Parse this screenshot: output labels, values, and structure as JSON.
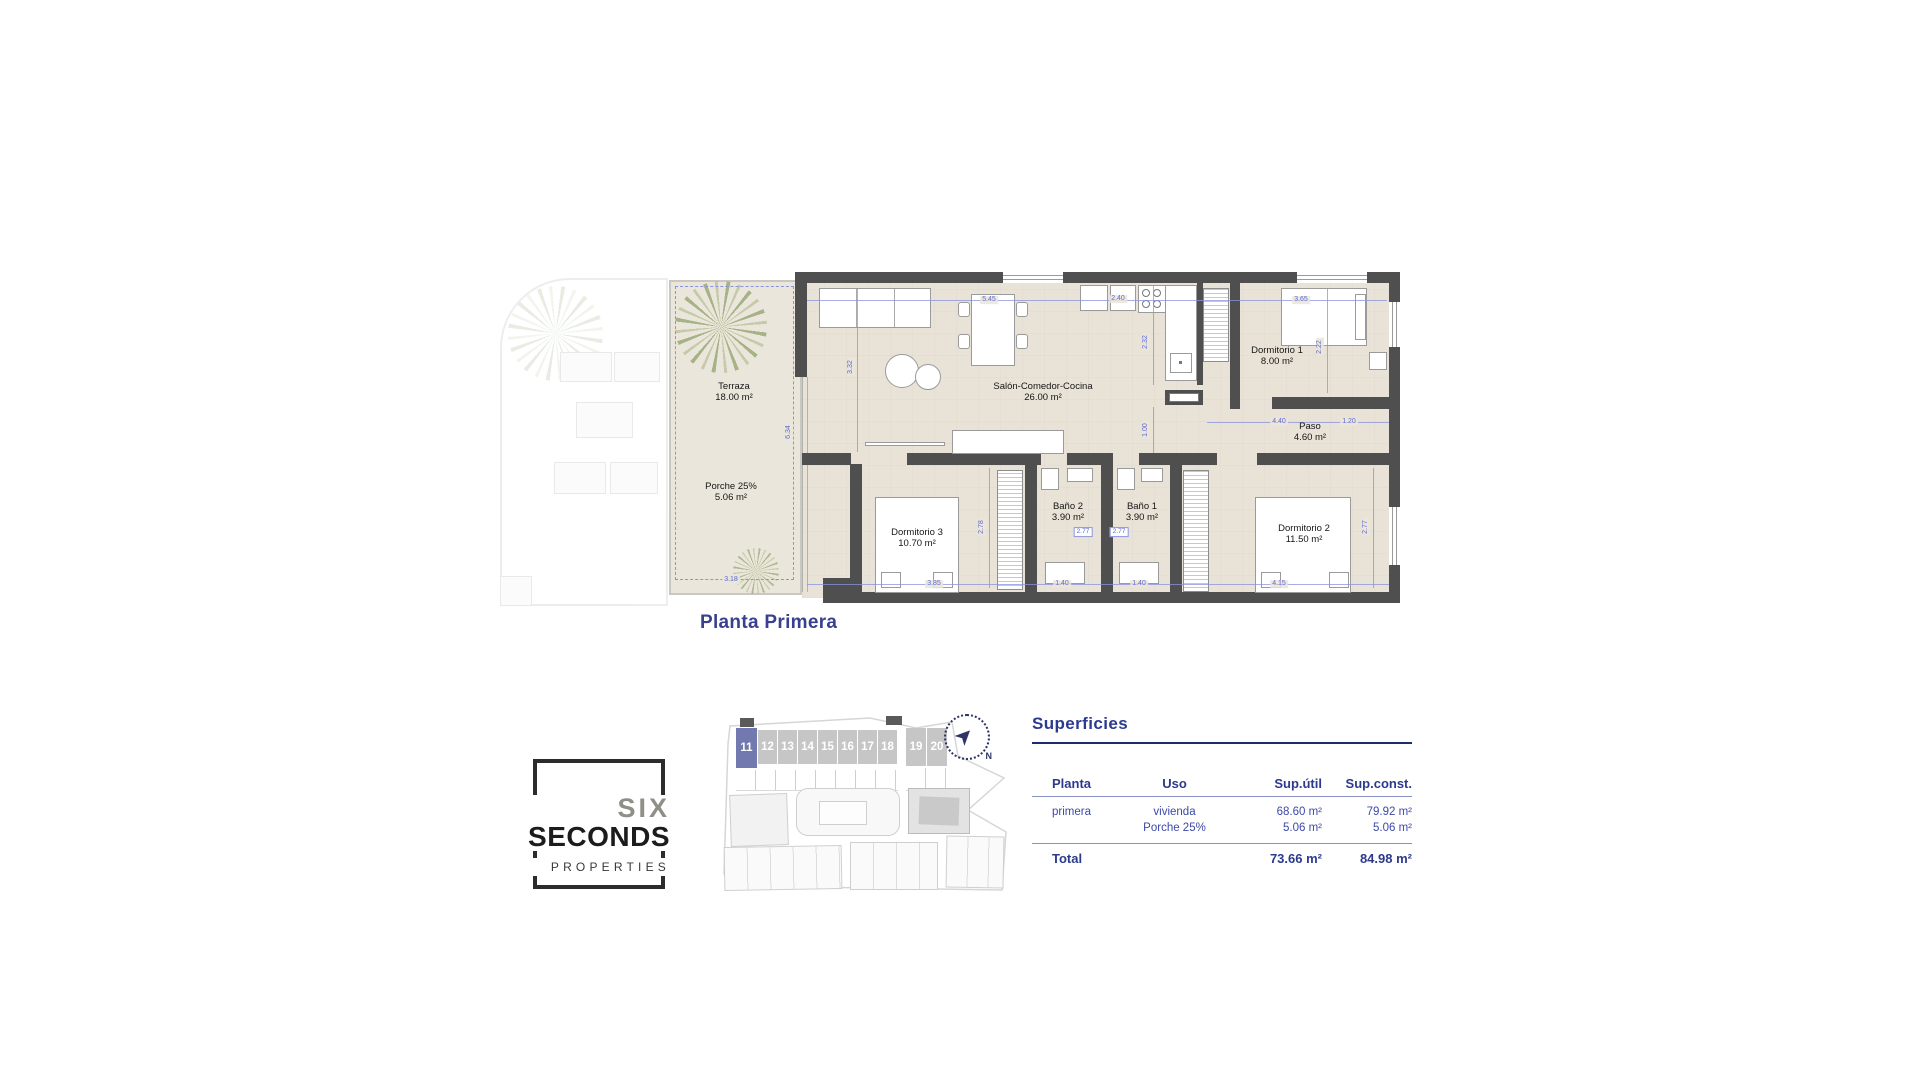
{
  "page": {
    "background": "#ffffff"
  },
  "colors": {
    "accent_navy": "#2c3a8e",
    "wall": "#4f4f4f",
    "floor": "#e8e2d7",
    "dim_blue": "#5f6bd0",
    "unit_highlight": "#7179ae"
  },
  "floor_plan": {
    "title": "Planta Primera",
    "rooms": {
      "terraza": {
        "name": "Terraza",
        "area": "18.00 m²"
      },
      "porche": {
        "name": "Porche 25%",
        "area": "5.06 m²"
      },
      "salon": {
        "name": "Salón-Comedor-Cocina",
        "area": "26.00 m²"
      },
      "dormitorio1": {
        "name": "Dormitorio 1",
        "area": "8.00 m²"
      },
      "paso": {
        "name": "Paso",
        "area": "4.60 m²"
      },
      "dormitorio3": {
        "name": "Dormitorio 3",
        "area": "10.70 m²"
      },
      "bano2": {
        "name": "Baño 2",
        "area": "3.90 m²"
      },
      "bano1": {
        "name": "Baño 1",
        "area": "3.90 m²"
      },
      "dormitorio2": {
        "name": "Dormitorio 2",
        "area": "11.50 m²"
      }
    },
    "dims": {
      "top_salon": "5.45",
      "top_cocina": "2.40",
      "top_dorm1": "3.65",
      "salon_v": "3.32",
      "cocina_v": "2.32",
      "dorm1_v": "2.22",
      "terraza_v": "6.34",
      "paso_v": "1.00",
      "paso_h": "4.40",
      "paso_h2": "1.20",
      "dorm3_v": "2.78",
      "bano2_box": "2.77",
      "bano1_box": "2.77",
      "dorm2_v": "2.77",
      "dorm3_b": "3.85",
      "bano2_b": "1.40",
      "bano1_b": "1.40",
      "dorm2_b": "4.15",
      "porche_b": "3.18"
    }
  },
  "site_plan": {
    "units": [
      "11",
      "12",
      "13",
      "14",
      "15",
      "16",
      "17",
      "18",
      "19",
      "20"
    ],
    "highlighted_unit": "11",
    "compass_label": "N"
  },
  "logo": {
    "top": "SIX",
    "middle": "SECONDS",
    "bottom": "PROPERTIES"
  },
  "surfaces": {
    "title": "Superficies",
    "col_planta": "Planta",
    "col_uso": "Uso",
    "col_util": "Sup.útil",
    "col_const": "Sup.const.",
    "r1_planta": "primera",
    "r1_uso": "vivienda",
    "r1_util": "68.60 m²",
    "r1_const": "79.92 m²",
    "r2_uso": "Porche 25%",
    "r2_util": "5.06 m²",
    "r2_const": "5.06 m²",
    "total_label": "Total",
    "total_util": "73.66 m²",
    "total_const": "84.98 m²"
  }
}
